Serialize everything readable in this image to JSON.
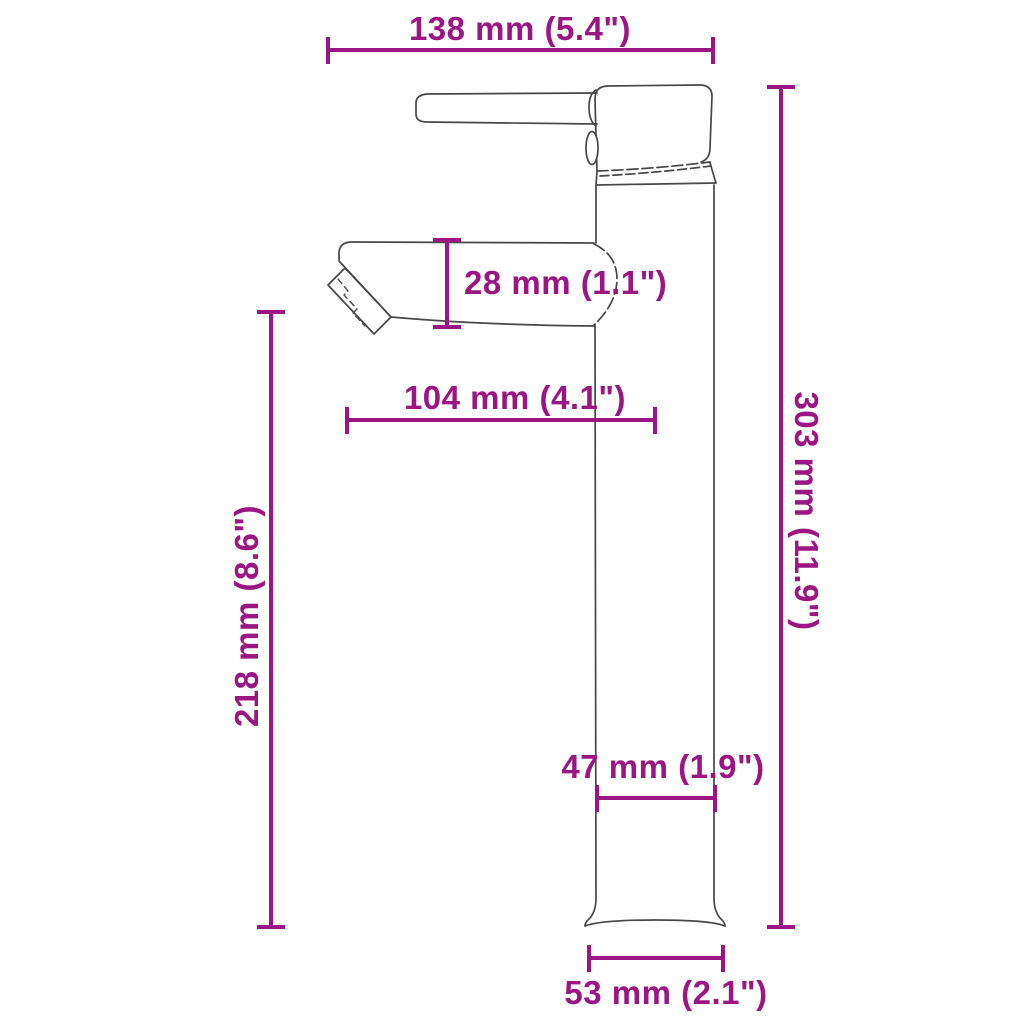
{
  "title": "Tall basin mixer tap dimension diagram",
  "colors": {
    "dimension": "#9b1583",
    "outline": "#474747",
    "background": "#ffffff"
  },
  "dimensions": {
    "top_width": {
      "label": "138 mm (5.4\")",
      "value_mm": 138,
      "value_in": 5.4
    },
    "spout_height": {
      "label": "28 mm (1.1\")",
      "value_mm": 28,
      "value_in": 1.1
    },
    "spout_reach": {
      "label": "104 mm (4.1\")",
      "value_mm": 104,
      "value_in": 4.1
    },
    "spout_to_base": {
      "label": "218 mm (8.6\")",
      "value_mm": 218,
      "value_in": 8.6
    },
    "total_height": {
      "label": "303 mm (11.9\")",
      "value_mm": 303,
      "value_in": 11.9
    },
    "body_width": {
      "label": "47 mm (1.9\")",
      "value_mm": 47,
      "value_in": 1.9
    },
    "base_width": {
      "label": "53 mm (2.1\")",
      "value_mm": 53,
      "value_in": 2.1
    }
  }
}
